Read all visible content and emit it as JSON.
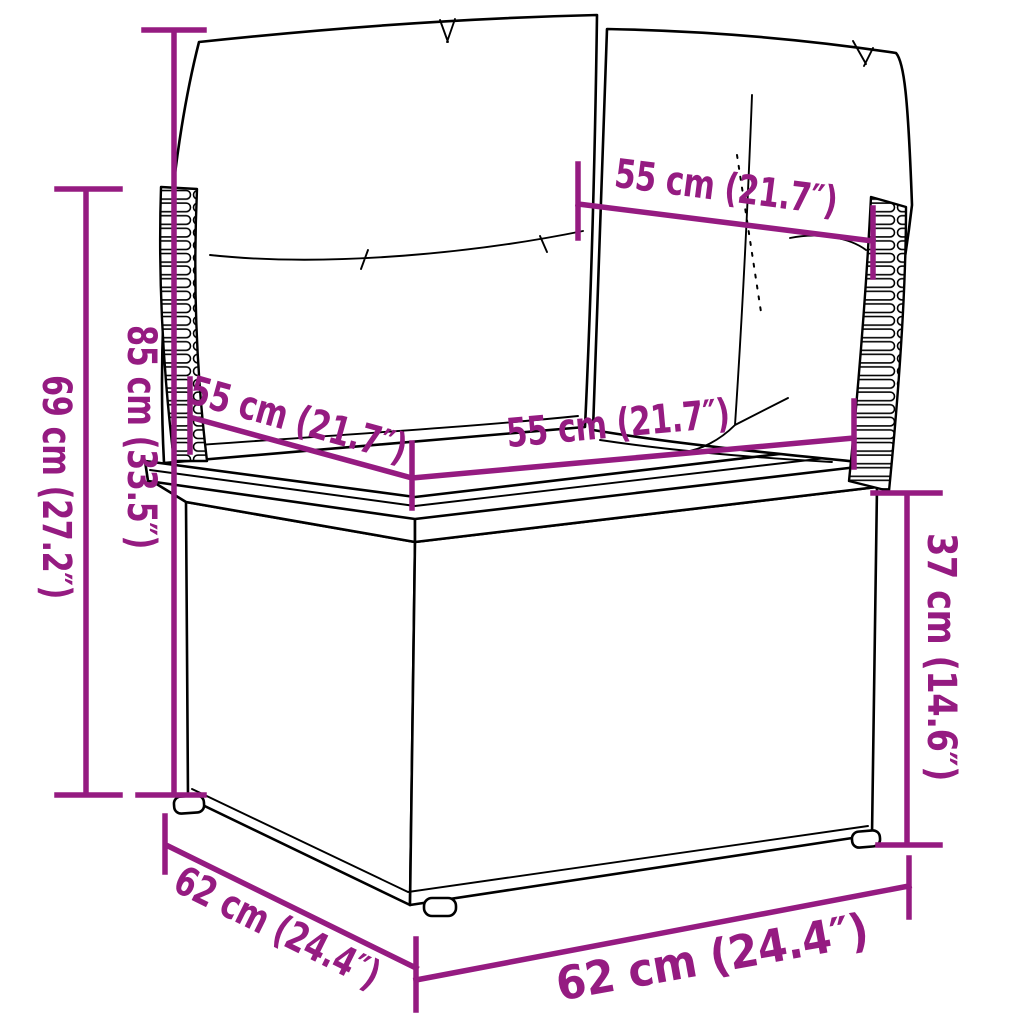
{
  "diagram": {
    "illustration": "rattan-corner-sofa-section-with-cushions",
    "colors": {
      "accent": "#951b81",
      "outline": "#000000",
      "background": "#ffffff"
    },
    "dimensions": {
      "back_cushion_width": {
        "label": "55 cm (21.7″)"
      },
      "seat_width": {
        "label": "55 cm (21.7″)"
      },
      "seat_depth": {
        "label": "55 cm (21.7″)"
      },
      "total_height": {
        "label": "85 cm (33.5″)"
      },
      "back_height": {
        "label": "69 cm (27.2″)"
      },
      "seat_height": {
        "label": "37 cm (14.6″)"
      },
      "base_depth": {
        "label": "62 cm (24.4″)"
      },
      "base_width": {
        "label": "62 cm (24.4″)"
      }
    }
  }
}
